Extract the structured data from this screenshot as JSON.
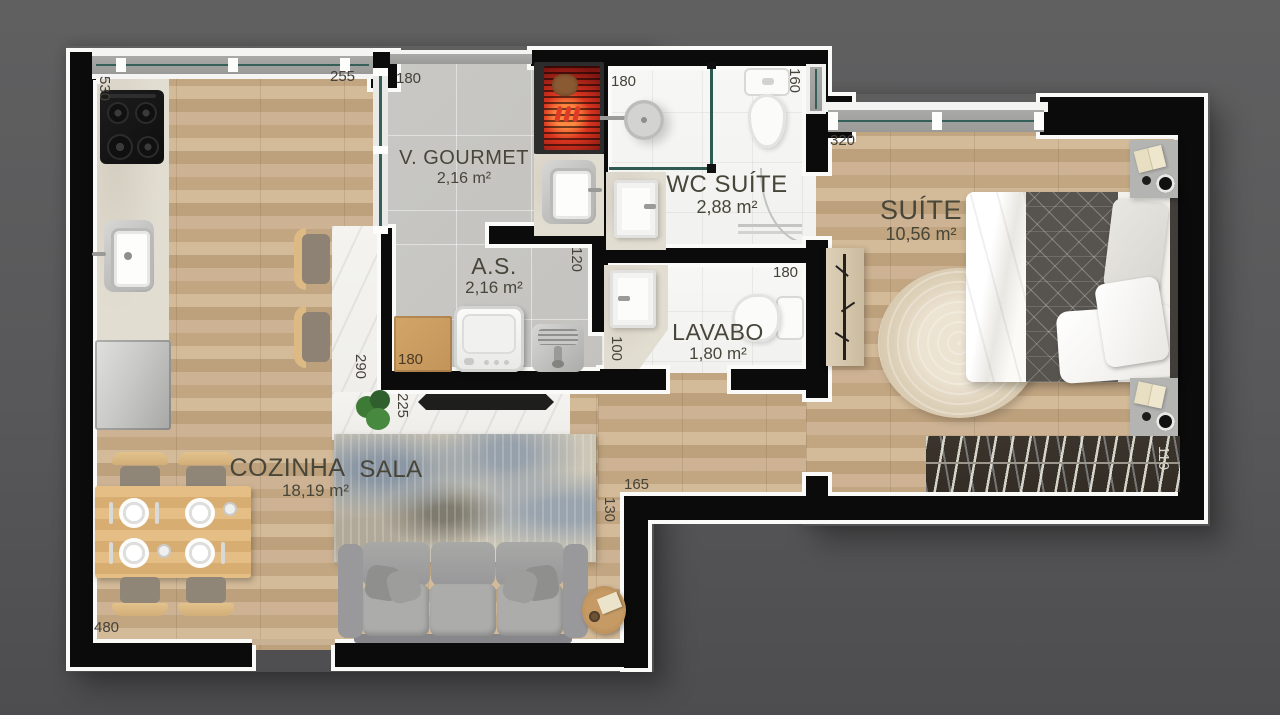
{
  "plan_title": "Apartment floor plan",
  "rooms": [
    {
      "name": "COZINHA",
      "area": "18,19 m²"
    },
    {
      "name": "SALA"
    },
    {
      "name": "V. GOURMET",
      "area": "2,16 m²"
    },
    {
      "name": "A.S.",
      "area": "2,16 m²"
    },
    {
      "name": "WC SUÍTE",
      "area": "2,88 m²"
    },
    {
      "name": "LAVABO",
      "area": "1,80 m²"
    },
    {
      "name": "SUÍTE",
      "area": "10,56 m²"
    }
  ],
  "dimensions_cm": {
    "kitchen_left": "530",
    "kitchen_window": "255",
    "vgourmet_top": "180",
    "wcsuite_top": "180",
    "wcsuite_right": "160",
    "suite_window": "320",
    "as_right": "120",
    "as_cabinet": "180",
    "lavabo_left": "100",
    "lavabo_top": "180",
    "island_long": "290",
    "island_short": "225",
    "hall_width": "165",
    "hall_step": "130",
    "bottom_wall": "480",
    "rack_width": "110"
  },
  "colors": {
    "background": "#58585a",
    "wall": "#0b0b0b",
    "wall_outline": "#fafaf8",
    "wood_floor": "#c8ad8e",
    "concrete_floor": "#c7c6c2",
    "tile_floor": "#f6f6f4",
    "glass": "#2e5a52",
    "label_text": "#45423a"
  }
}
